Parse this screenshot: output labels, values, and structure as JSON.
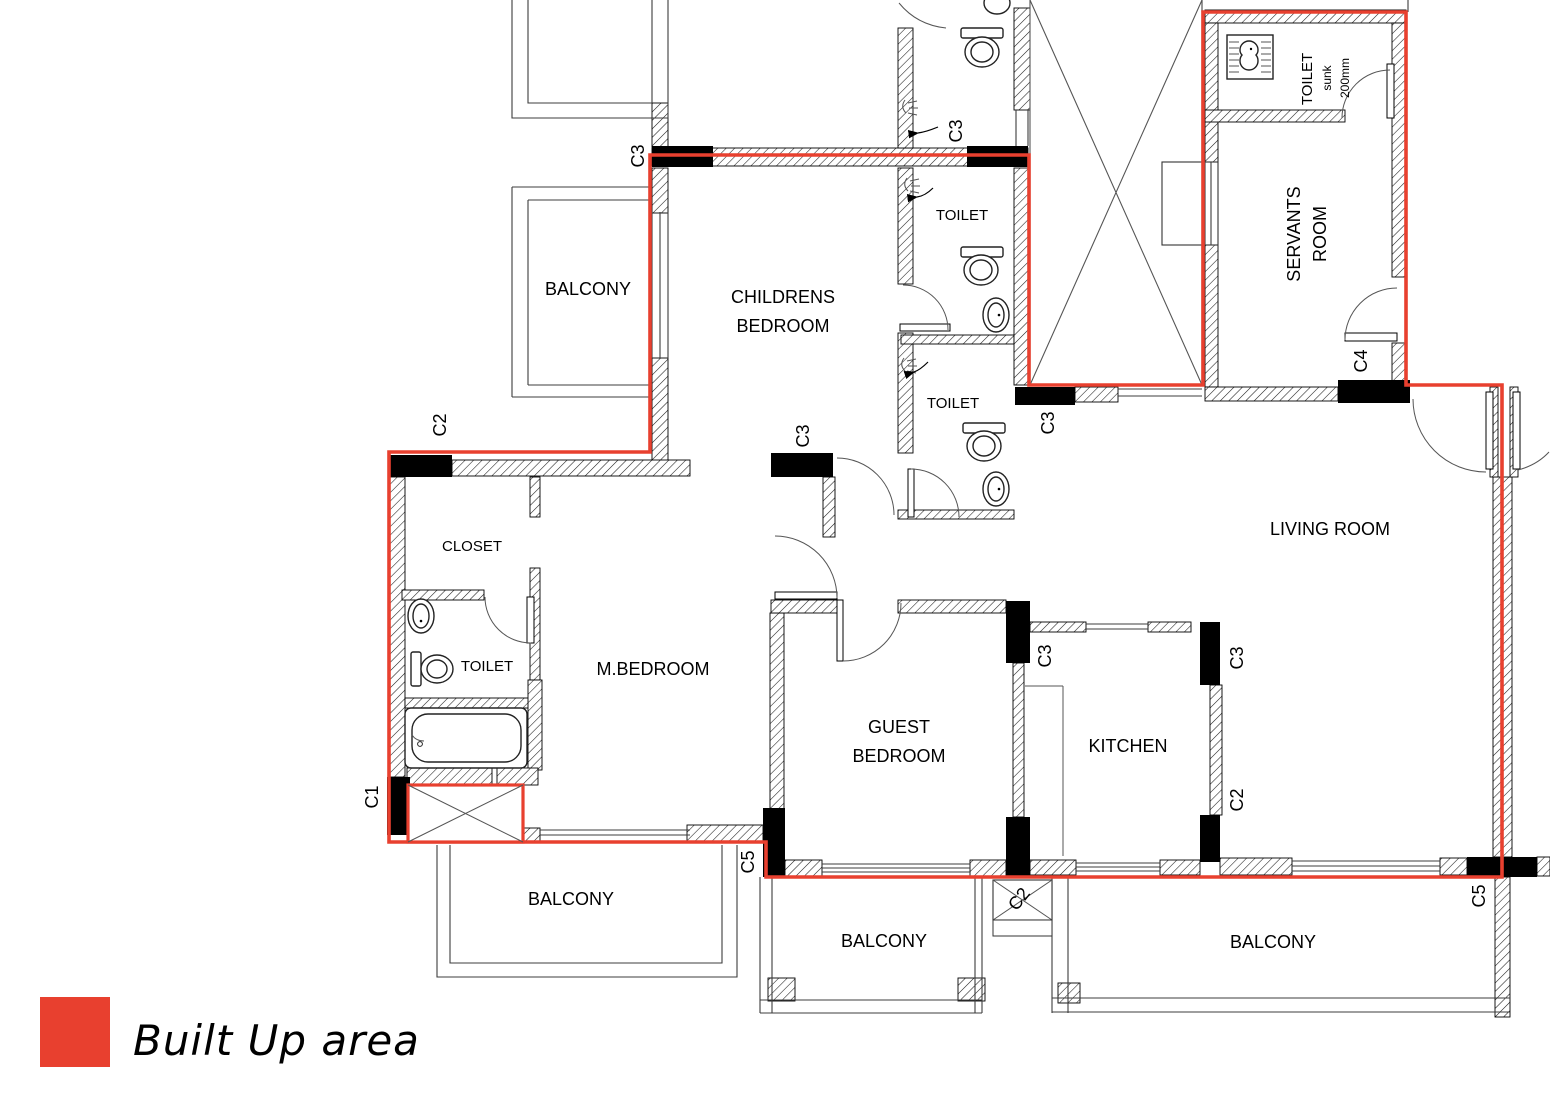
{
  "colors": {
    "builtup": "#e8402f",
    "wall": "#000000"
  },
  "legend": {
    "label": "Built Up area"
  },
  "labels": {
    "balcony_top_left": "BALCONY",
    "childrens_line1": "CHILDRENS",
    "childrens_line2": "BEDROOM",
    "toilet_mid": "TOILET",
    "toilet_lower": "TOILET",
    "servants_toilet_line1": "TOILET",
    "servants_toilet_line2": "sunk",
    "servants_toilet_line3": "200mm",
    "servants_line1": "SERVANTS",
    "servants_line2": "ROOM",
    "living_room": "LIVING ROOM",
    "closet": "CLOSET",
    "toilet_master": "TOILET",
    "master_bedroom": "M.BEDROOM",
    "guest_line1": "GUEST",
    "guest_line2": "BEDROOM",
    "kitchen": "KITCHEN",
    "balcony_bottom_left": "BALCONY",
    "balcony_bottom_center": "BALCONY",
    "balcony_bottom_right": "BALCONY"
  },
  "markers": {
    "c3_top_left": "C3",
    "c3_toilet_top": "C3",
    "c2_left": "C2",
    "c3_hall": "C3",
    "c3_shaft": "C3",
    "c4": "C4",
    "c3_kitchen_left": "C3",
    "c3_kitchen_right": "C3",
    "c2_kitchen": "C2",
    "c1": "C1",
    "c5_left": "C5",
    "c2_balcony": "C2",
    "c5_right": "C5"
  }
}
